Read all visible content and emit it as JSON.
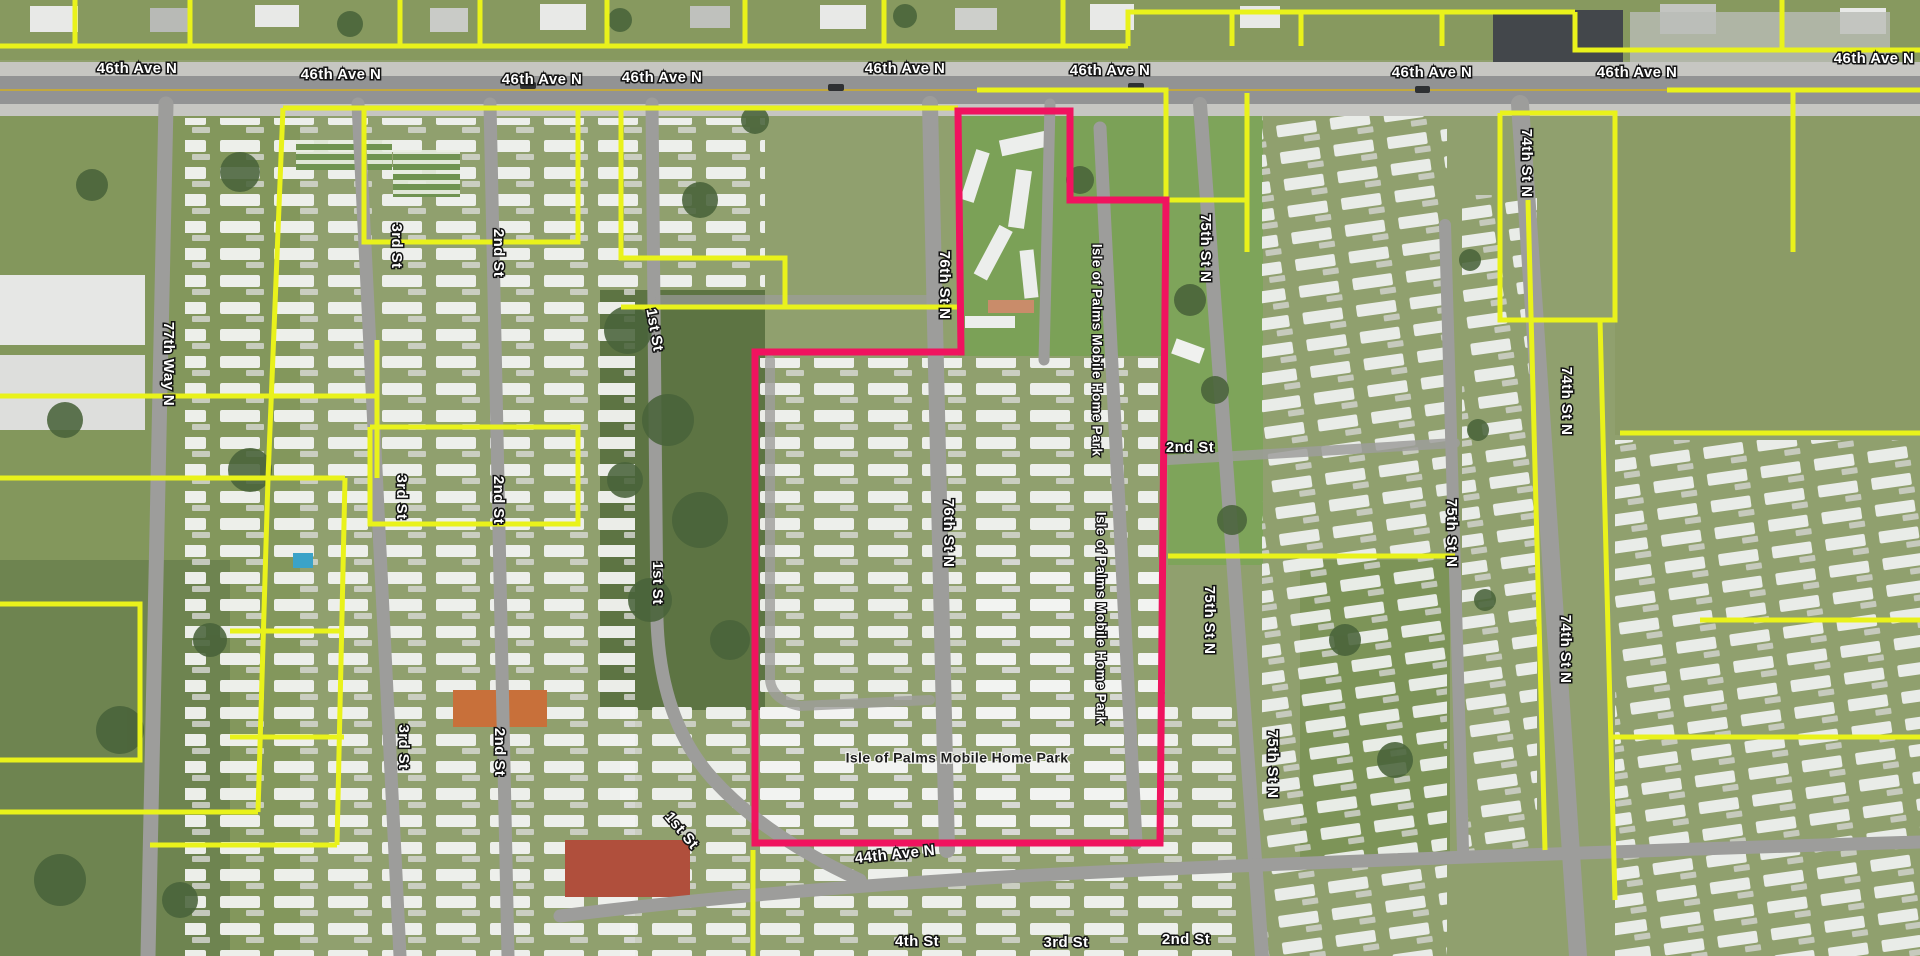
{
  "map": {
    "title": "aerial parcel map - Isle of Palms Mobile Home Park area",
    "highlighted_parcel_name": "Isle of Palms Mobile Home Park",
    "colors": {
      "parcel_line": "#e9f21b",
      "highlight_parcel_line": "#f0135f",
      "street_label_fill": "#ffffff",
      "street_label_halo": "#141414",
      "park_label_fill": "#1d1d1d",
      "park_label_halo": "#f4f4f2",
      "road": "#9d9d9b",
      "main_road": "#929394"
    },
    "labels": [
      {
        "text": "46th Ave N"
      },
      {
        "text": "46th Ave N"
      },
      {
        "text": "46th Ave N"
      },
      {
        "text": "46th Ave N"
      },
      {
        "text": "46th Ave N"
      },
      {
        "text": "46th Ave N"
      },
      {
        "text": "46th Ave N"
      },
      {
        "text": "46th Ave N"
      },
      {
        "text": "46th Ave N"
      },
      {
        "text": "77th Way N"
      },
      {
        "text": "3rd St"
      },
      {
        "text": "2nd St"
      },
      {
        "text": "1st St"
      },
      {
        "text": "3rd St"
      },
      {
        "text": "2nd St"
      },
      {
        "text": "1st St"
      },
      {
        "text": "3rd St"
      },
      {
        "text": "2nd St"
      },
      {
        "text": "1st St"
      },
      {
        "text": "76th St N"
      },
      {
        "text": "76th St N"
      },
      {
        "text": "Isle of Palms Mobile Home Park"
      },
      {
        "text": "Isle of Palms Mobile Home Park"
      },
      {
        "text": "75th St N"
      },
      {
        "text": "75th St N"
      },
      {
        "text": "75th St N"
      },
      {
        "text": "75th St N"
      },
      {
        "text": "74th St N"
      },
      {
        "text": "74th St N"
      },
      {
        "text": "74th St N"
      },
      {
        "text": "Isle of Palms Mobile Home Park"
      },
      {
        "text": "44th Ave N"
      },
      {
        "text": "4th St"
      },
      {
        "text": "3rd St"
      },
      {
        "text": "2nd St"
      },
      {
        "text": "2nd St"
      }
    ]
  }
}
